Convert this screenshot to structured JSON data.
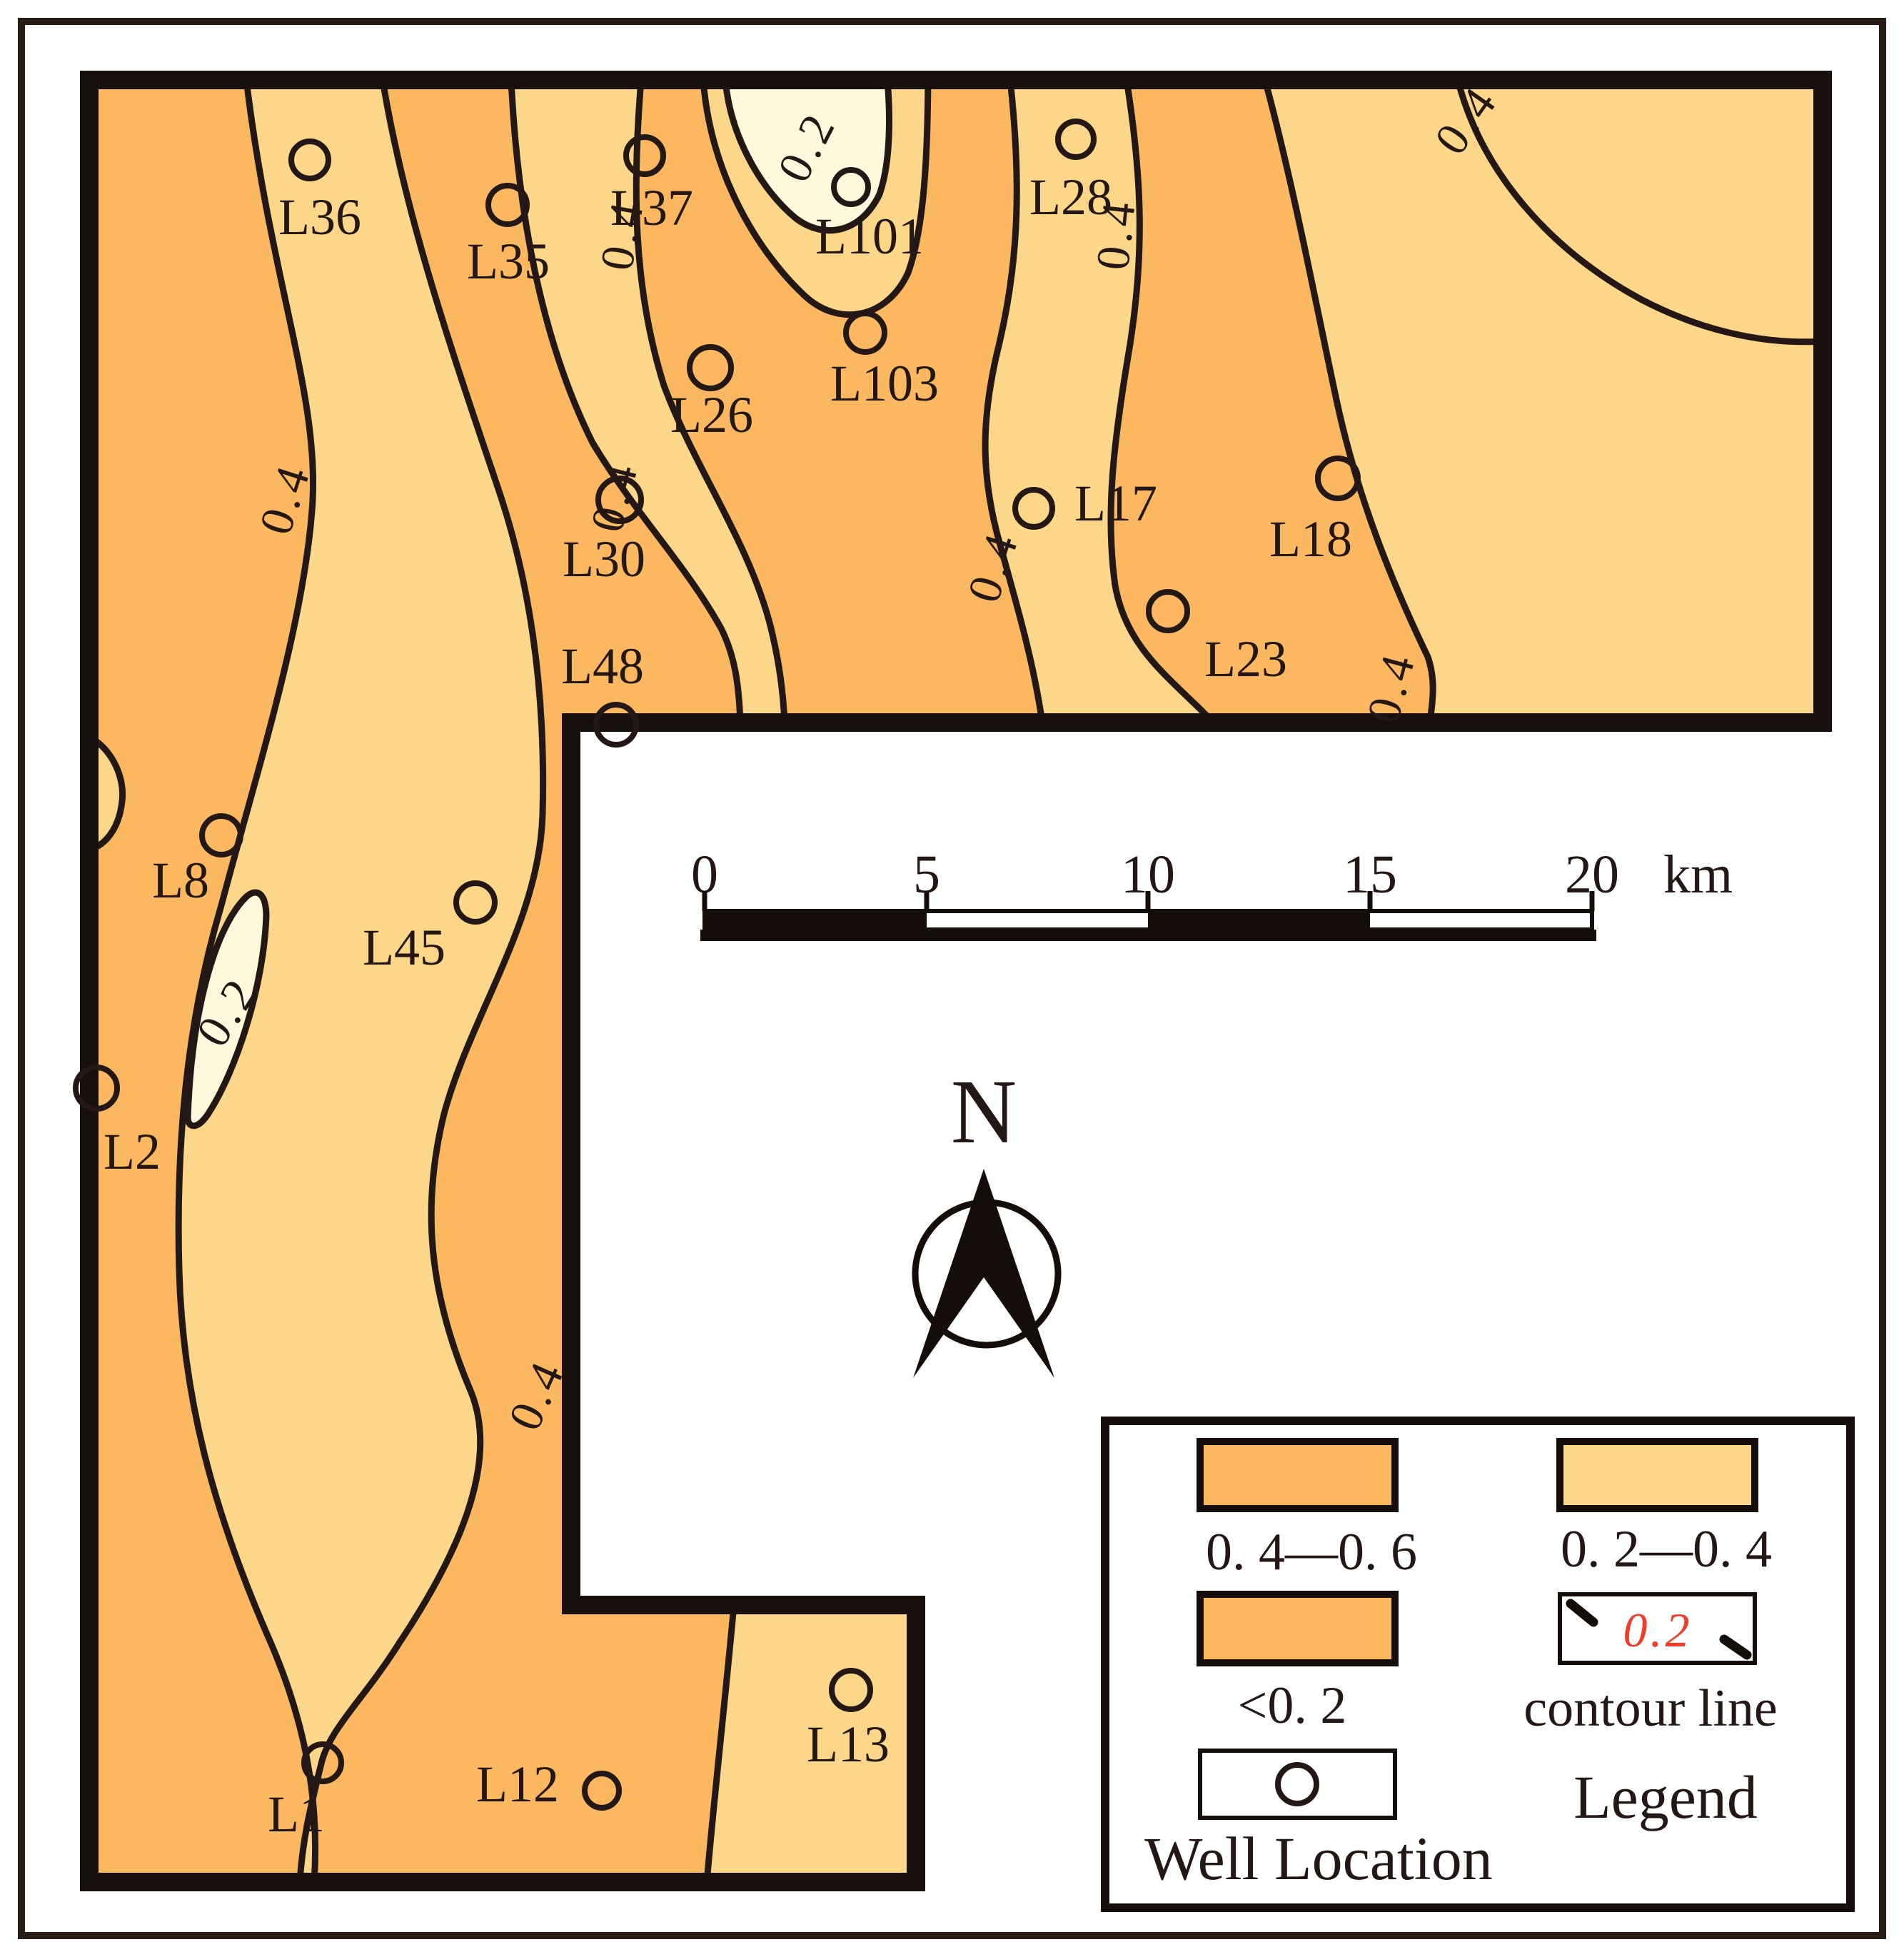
{
  "map": {
    "wells": [
      {
        "label": "L36"
      },
      {
        "label": "L35"
      },
      {
        "label": "L37"
      },
      {
        "label": "L101"
      },
      {
        "label": "L103"
      },
      {
        "label": "L26"
      },
      {
        "label": "L30"
      },
      {
        "label": "L48"
      },
      {
        "label": "L28"
      },
      {
        "label": "L17"
      },
      {
        "label": "L18"
      },
      {
        "label": "L23"
      },
      {
        "label": "L8"
      },
      {
        "label": "L45"
      },
      {
        "label": "L2"
      },
      {
        "label": "L1"
      },
      {
        "label": "L12"
      },
      {
        "label": "L13"
      }
    ],
    "contour_labels": [
      {
        "value": "0.4"
      },
      {
        "value": "0.4"
      },
      {
        "value": "0.2"
      },
      {
        "value": "0.4"
      },
      {
        "value": "0.4"
      },
      {
        "value": "0.4"
      },
      {
        "value": "0.4"
      },
      {
        "value": "0.4"
      },
      {
        "value": "0.2"
      },
      {
        "value": "0.4"
      }
    ],
    "colors": {
      "band_04_06": "#fcb860",
      "band_02_04": "#fcd689",
      "band_below_02": "#fff8dc",
      "line": "#231815",
      "legend_red": "#ee3d28"
    }
  },
  "scale_bar": {
    "ticks": [
      "0",
      "5",
      "10",
      "15",
      "20"
    ],
    "unit": "km"
  },
  "north": {
    "label": "N"
  },
  "legend": {
    "title": "Legend",
    "items": [
      {
        "range": "0. 4—0. 6"
      },
      {
        "range": "0. 2—0. 4"
      },
      {
        "range": "<0. 2"
      },
      {
        "label": "contour line",
        "value": "0.2"
      },
      {
        "label": "Well Location"
      }
    ]
  }
}
